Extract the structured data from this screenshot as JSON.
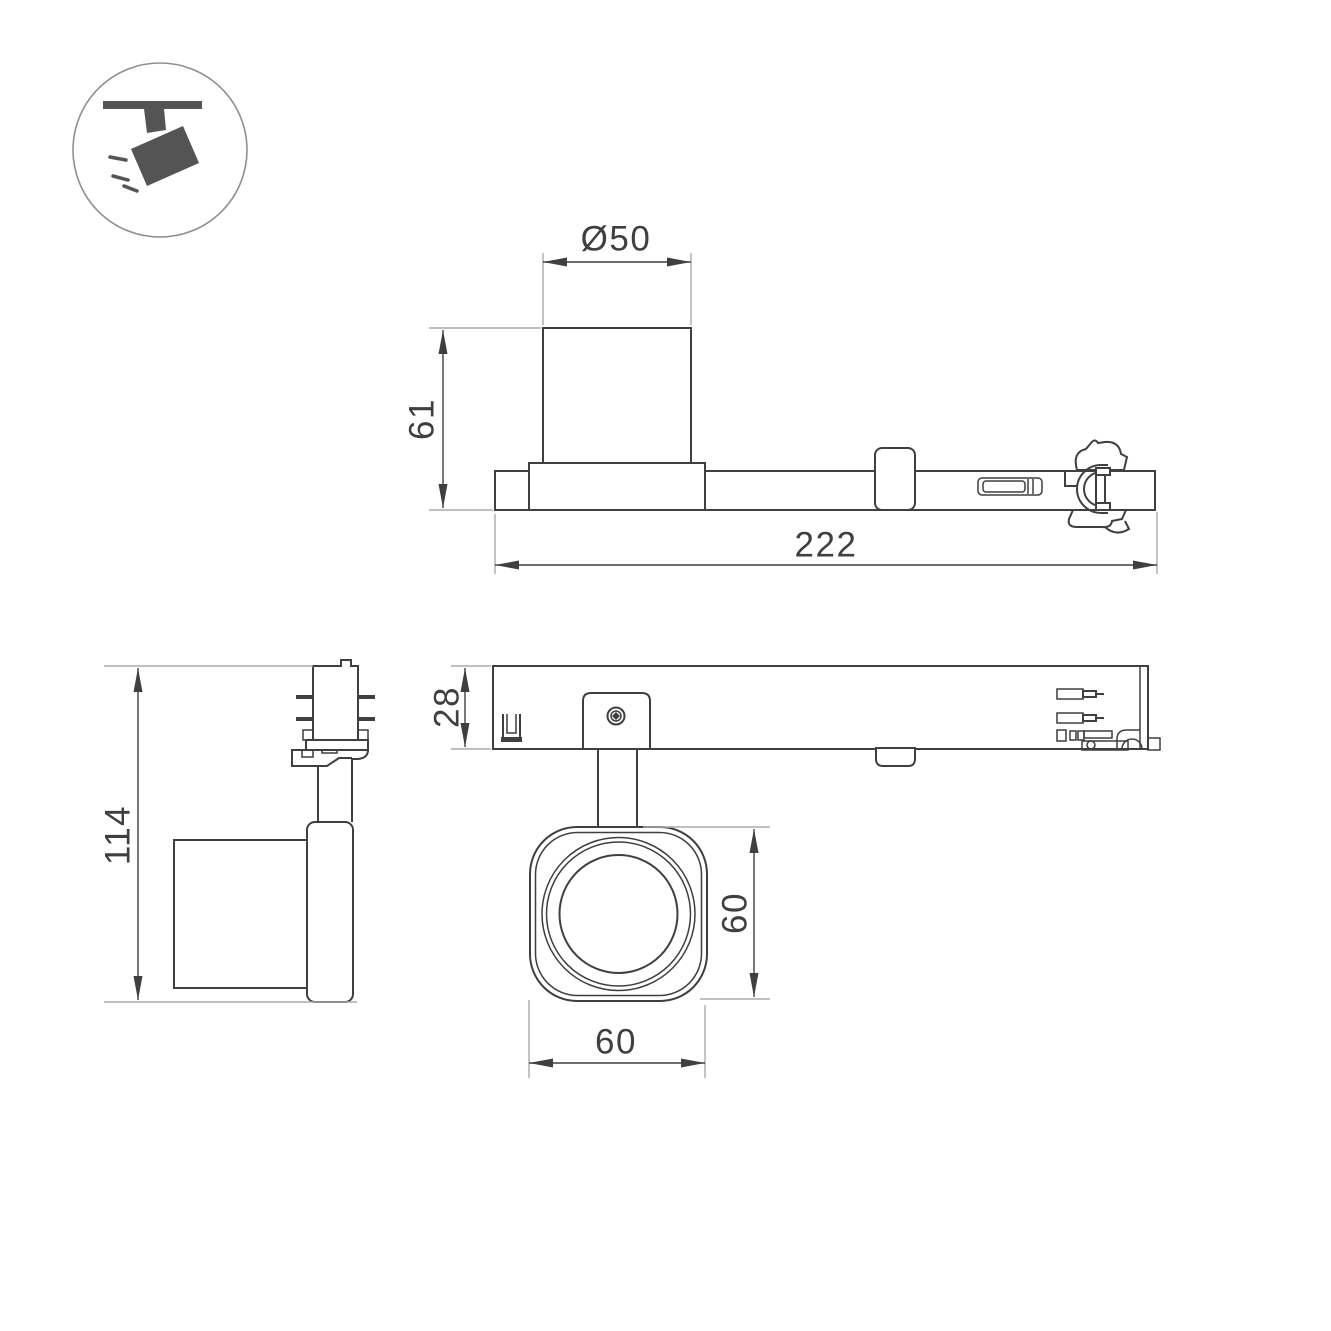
{
  "drawing": {
    "background": "#ffffff",
    "line_color": "#3f3f3f",
    "extension_line_color": "#ababab",
    "icon": {
      "name": "track-spotlight-icon",
      "pictogram_color": "#545454",
      "circle_color": "#8f8f8f"
    },
    "dimensions": {
      "head_diameter": "Ø50",
      "adapter_height": "61",
      "total_length": "222",
      "fixture_height": "114",
      "track_depth": "28",
      "head_height": "60",
      "head_width": "60"
    }
  }
}
